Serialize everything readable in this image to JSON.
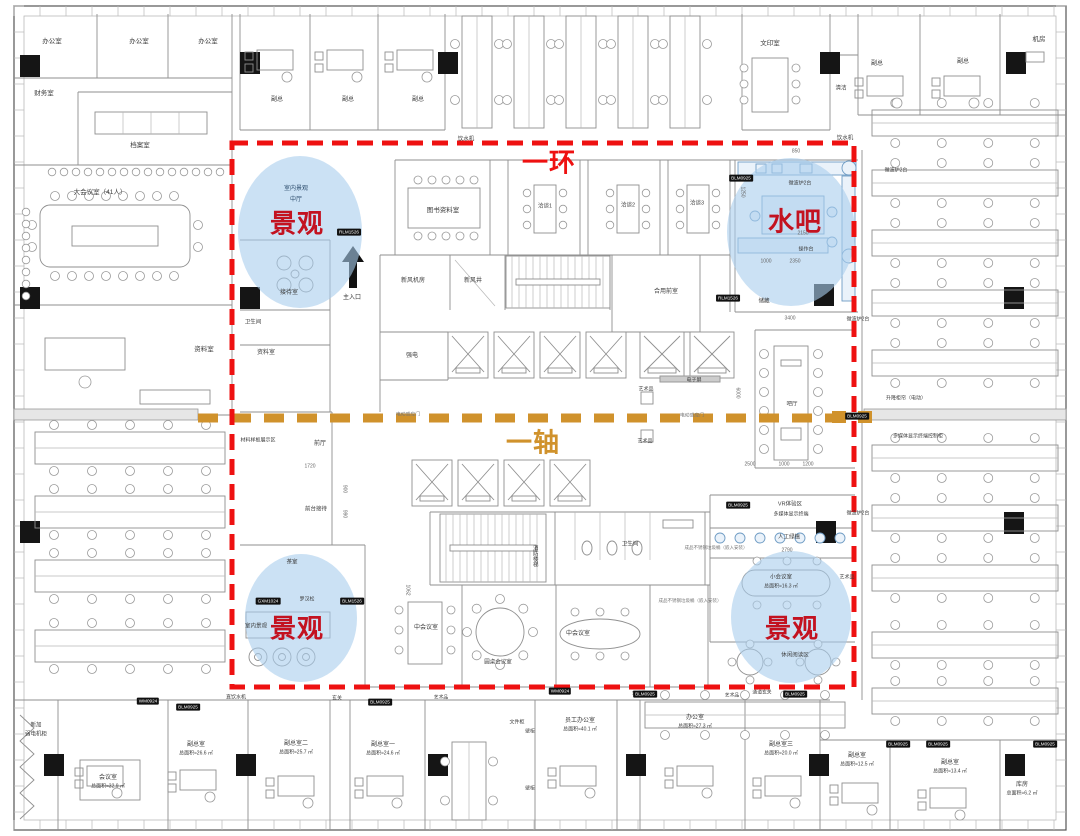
{
  "overlays": {
    "ring": {
      "label": "一环",
      "color": "#ee1111"
    },
    "axis": {
      "label": "一轴",
      "color": "#d0922c"
    },
    "zones": [
      {
        "id": "landscape-top-left",
        "label": "景观"
      },
      {
        "id": "water-bar-top-right",
        "label": "水吧"
      },
      {
        "id": "landscape-bottom-left",
        "label": "景观"
      },
      {
        "id": "landscape-bottom-right",
        "label": "景观"
      }
    ],
    "zone_fill": "#a9cdec",
    "zone_label_color": "#c31220"
  },
  "plan_labels": [
    {
      "t": "办公室",
      "x": 52,
      "y": 42
    },
    {
      "t": "办公室",
      "x": 139,
      "y": 42
    },
    {
      "t": "办公室",
      "x": 208,
      "y": 42
    },
    {
      "t": "财务室",
      "x": 44,
      "y": 94
    },
    {
      "t": "档案室",
      "x": 140,
      "y": 146
    },
    {
      "t": "大会议室（41人）",
      "x": 100,
      "y": 193
    },
    {
      "t": "资料室",
      "x": 204,
      "y": 350
    },
    {
      "t": "副总",
      "x": 277,
      "y": 100,
      "s": 6
    },
    {
      "t": "副总",
      "x": 348,
      "y": 100,
      "s": 6
    },
    {
      "t": "副总",
      "x": 418,
      "y": 100,
      "s": 6
    },
    {
      "t": "饮水机",
      "x": 466,
      "y": 140,
      "s": 5.5
    },
    {
      "t": "文印室",
      "x": 770,
      "y": 44
    },
    {
      "t": "清洁",
      "x": 841,
      "y": 89,
      "s": 5.5
    },
    {
      "t": "副总",
      "x": 877,
      "y": 64,
      "s": 6
    },
    {
      "t": "副总",
      "x": 963,
      "y": 62,
      "s": 6
    },
    {
      "t": "机房",
      "x": 1039,
      "y": 40
    },
    {
      "t": "饮水机",
      "x": 845,
      "y": 139,
      "s": 5.5
    },
    {
      "t": "室内景观",
      "x": 296,
      "y": 189,
      "s": 6,
      "c": "#2f4f6f"
    },
    {
      "t": "中厅",
      "x": 296,
      "y": 200,
      "s": 6,
      "c": "#2f4f6f"
    },
    {
      "t": "接待室",
      "x": 289,
      "y": 293,
      "s": 6
    },
    {
      "t": "主入口",
      "x": 352,
      "y": 298,
      "s": 6
    },
    {
      "t": "卫生间",
      "x": 253,
      "y": 323,
      "s": 5.5
    },
    {
      "t": "资料室",
      "x": 266,
      "y": 353,
      "s": 6
    },
    {
      "t": "图书资料室",
      "x": 443,
      "y": 211
    },
    {
      "t": "洽谈1",
      "x": 545,
      "y": 207,
      "s": 5.5
    },
    {
      "t": "洽谈2",
      "x": 628,
      "y": 206,
      "s": 5.5
    },
    {
      "t": "洽谈3",
      "x": 697,
      "y": 204,
      "s": 5.5
    },
    {
      "t": "新风机房",
      "x": 413,
      "y": 281,
      "s": 6
    },
    {
      "t": "新风井",
      "x": 473,
      "y": 281,
      "s": 6
    },
    {
      "t": "合用前室",
      "x": 666,
      "y": 292,
      "s": 6
    },
    {
      "t": "强电",
      "x": 412,
      "y": 356,
      "s": 6
    },
    {
      "t": "储藏",
      "x": 764,
      "y": 302,
      "s": 5.5
    },
    {
      "t": "微波炉2台",
      "x": 800,
      "y": 184,
      "s": 5
    },
    {
      "t": "操作台",
      "x": 806,
      "y": 250,
      "s": 5
    },
    {
      "t": "微波炉2台",
      "x": 896,
      "y": 171,
      "s": 5
    },
    {
      "t": "电子屏",
      "x": 694,
      "y": 381,
      "s": 5
    },
    {
      "t": "艺术品",
      "x": 646,
      "y": 390,
      "s": 5
    },
    {
      "t": "艺术品",
      "x": 645,
      "y": 442,
      "s": 5
    },
    {
      "t": "电动感应门",
      "x": 408,
      "y": 416,
      "s": 4.8,
      "c": "#777777"
    },
    {
      "t": "电动感应门",
      "x": 692,
      "y": 417,
      "s": 4.8,
      "c": "#777777"
    },
    {
      "t": "吧厅",
      "x": 792,
      "y": 405,
      "s": 5.5
    },
    {
      "t": "前厅",
      "x": 320,
      "y": 444,
      "s": 6
    },
    {
      "t": "材料样板展示区",
      "x": 258,
      "y": 441,
      "s": 5
    },
    {
      "t": "前台接待",
      "x": 316,
      "y": 510,
      "s": 5.5
    },
    {
      "t": "茶室",
      "x": 292,
      "y": 563,
      "s": 5.5
    },
    {
      "t": "罗汉松",
      "x": 307,
      "y": 600,
      "s": 5
    },
    {
      "t": "室内景观",
      "x": 256,
      "y": 627,
      "s": 5.5
    },
    {
      "t": "消防楼梯",
      "x": 534,
      "y": 556,
      "s": 5.5,
      "v": true
    },
    {
      "t": "卫生间",
      "x": 630,
      "y": 545,
      "s": 5.5
    },
    {
      "t": "中会议室",
      "x": 426,
      "y": 628,
      "s": 6
    },
    {
      "t": "圆桌会议室",
      "x": 498,
      "y": 663,
      "s": 5.5
    },
    {
      "t": "中会议室",
      "x": 578,
      "y": 634,
      "s": 6
    },
    {
      "t": "VR体验区",
      "x": 790,
      "y": 505,
      "s": 5.5
    },
    {
      "t": "多媒体显示终端",
      "x": 791,
      "y": 515,
      "s": 5
    },
    {
      "t": "人工绿植",
      "x": 789,
      "y": 538,
      "s": 5.5
    },
    {
      "t": "小会议室",
      "x": 781,
      "y": 578,
      "s": 5.5
    },
    {
      "t": "总面积≈16.3 ㎡",
      "x": 781,
      "y": 587,
      "s": 5
    },
    {
      "t": "艺术品",
      "x": 847,
      "y": 578,
      "s": 5
    },
    {
      "t": "休闲阅读区",
      "x": 795,
      "y": 656,
      "s": 5.5
    },
    {
      "t": "成品不锈钢垃圾桶（嵌入安装）",
      "x": 716,
      "y": 548,
      "s": 4.5,
      "c": "#777777"
    },
    {
      "t": "成品不锈钢垃圾桶（嵌入安装）",
      "x": 690,
      "y": 601,
      "s": 4.5,
      "c": "#777777"
    },
    {
      "t": "微波炉2台",
      "x": 858,
      "y": 320,
      "s": 5
    },
    {
      "t": "升降柜帘（电动）",
      "x": 906,
      "y": 399,
      "s": 5
    },
    {
      "t": "多媒体显示终端控制柜",
      "x": 918,
      "y": 437,
      "s": 5
    },
    {
      "t": "微波炉2台",
      "x": 858,
      "y": 514,
      "s": 5
    },
    {
      "t": "850",
      "x": 796,
      "y": 152,
      "s": 5,
      "c": "#666666"
    },
    {
      "t": "1250",
      "x": 742,
      "y": 192,
      "s": 5,
      "c": "#666666",
      "v": true
    },
    {
      "t": "2150",
      "x": 803,
      "y": 234,
      "s": 5,
      "c": "#666666"
    },
    {
      "t": "1000",
      "x": 766,
      "y": 262,
      "s": 5,
      "c": "#666666"
    },
    {
      "t": "2350",
      "x": 795,
      "y": 262,
      "s": 5,
      "c": "#666666"
    },
    {
      "t": "3400",
      "x": 790,
      "y": 319,
      "s": 5,
      "c": "#666666"
    },
    {
      "t": "6000",
      "x": 737,
      "y": 393,
      "s": 5,
      "c": "#666666",
      "v": true
    },
    {
      "t": "2500",
      "x": 750,
      "y": 465,
      "s": 5,
      "c": "#666666"
    },
    {
      "t": "1000",
      "x": 784,
      "y": 465,
      "s": 5,
      "c": "#666666"
    },
    {
      "t": "1200",
      "x": 808,
      "y": 465,
      "s": 5,
      "c": "#666666"
    },
    {
      "t": "1720",
      "x": 310,
      "y": 467,
      "s": 5,
      "c": "#666666"
    },
    {
      "t": "900",
      "x": 344,
      "y": 489,
      "s": 5,
      "c": "#666666",
      "v": true
    },
    {
      "t": "990",
      "x": 344,
      "y": 514,
      "s": 5,
      "c": "#666666",
      "v": true
    },
    {
      "t": "1062",
      "x": 407,
      "y": 590,
      "s": 5,
      "c": "#666666",
      "v": true
    },
    {
      "t": "2790",
      "x": 787,
      "y": 551,
      "s": 5,
      "c": "#666666"
    },
    {
      "t": "新加",
      "x": 36,
      "y": 726,
      "s": 5.5
    },
    {
      "t": "弱电机柜",
      "x": 36,
      "y": 735,
      "s": 5.5
    },
    {
      "t": "会议室",
      "x": 108,
      "y": 778,
      "s": 6
    },
    {
      "t": "总面积≈32.9 ㎡",
      "x": 108,
      "y": 787,
      "s": 5
    },
    {
      "t": "副总室",
      "x": 196,
      "y": 745,
      "s": 6
    },
    {
      "t": "总面积≈26.6 ㎡",
      "x": 196,
      "y": 754,
      "s": 5
    },
    {
      "t": "直饮水机",
      "x": 236,
      "y": 698,
      "s": 5
    },
    {
      "t": "玄关",
      "x": 337,
      "y": 699,
      "s": 5
    },
    {
      "t": "副总室二",
      "x": 296,
      "y": 744,
      "s": 6
    },
    {
      "t": "总面积≈25.7 ㎡",
      "x": 296,
      "y": 753,
      "s": 5
    },
    {
      "t": "副总室一",
      "x": 383,
      "y": 745,
      "s": 6
    },
    {
      "t": "总面积≈24.6 ㎡",
      "x": 383,
      "y": 754,
      "s": 5
    },
    {
      "t": "文件柜",
      "x": 517,
      "y": 723,
      "s": 5
    },
    {
      "t": "壁柜",
      "x": 530,
      "y": 733,
      "s": 4.8
    },
    {
      "t": "壁柜",
      "x": 530,
      "y": 790,
      "s": 4.8
    },
    {
      "t": "艺术品",
      "x": 441,
      "y": 699,
      "s": 4.8
    },
    {
      "t": "艺术品",
      "x": 639,
      "y": 695,
      "s": 4.8
    },
    {
      "t": "艺术品",
      "x": 732,
      "y": 697,
      "s": 4.8
    },
    {
      "t": "通道玄关",
      "x": 762,
      "y": 694,
      "s": 4.8
    },
    {
      "t": "员工办公室",
      "x": 580,
      "y": 721,
      "s": 6
    },
    {
      "t": "总面积≈40.1 ㎡",
      "x": 580,
      "y": 730,
      "s": 5
    },
    {
      "t": "办公室",
      "x": 695,
      "y": 718,
      "s": 6
    },
    {
      "t": "总面积≈27.3 ㎡",
      "x": 695,
      "y": 727,
      "s": 5
    },
    {
      "t": "副总室三",
      "x": 781,
      "y": 745,
      "s": 6
    },
    {
      "t": "总面积≈20.0 ㎡",
      "x": 781,
      "y": 754,
      "s": 5
    },
    {
      "t": "副总室",
      "x": 857,
      "y": 756,
      "s": 6
    },
    {
      "t": "总面积≈12.5 ㎡",
      "x": 857,
      "y": 765,
      "s": 5
    },
    {
      "t": "副总室",
      "x": 950,
      "y": 763,
      "s": 6
    },
    {
      "t": "总面积≈13.4 ㎡",
      "x": 950,
      "y": 772,
      "s": 5
    },
    {
      "t": "库房",
      "x": 1022,
      "y": 785,
      "s": 6
    },
    {
      "t": "总面积≈6.2 ㎡",
      "x": 1022,
      "y": 794,
      "s": 5
    }
  ],
  "tags": [
    {
      "t": "RLM1526",
      "x": 349,
      "y": 232
    },
    {
      "t": "BLM0925",
      "x": 741,
      "y": 178
    },
    {
      "t": "RLM1526",
      "x": 728,
      "y": 298
    },
    {
      "t": "BLM0925",
      "x": 857,
      "y": 416
    },
    {
      "t": "GXM1024",
      "x": 268,
      "y": 601
    },
    {
      "t": "BLM1526",
      "x": 352,
      "y": 601
    },
    {
      "t": "WM0924",
      "x": 148,
      "y": 701
    },
    {
      "t": "BLM0925",
      "x": 188,
      "y": 707
    },
    {
      "t": "BLM0925",
      "x": 380,
      "y": 702
    },
    {
      "t": "WM0924",
      "x": 560,
      "y": 691
    },
    {
      "t": "BLM0925",
      "x": 645,
      "y": 694
    },
    {
      "t": "BLM0925",
      "x": 795,
      "y": 694
    },
    {
      "t": "BLM0925",
      "x": 738,
      "y": 505
    },
    {
      "t": "BLM0925",
      "x": 898,
      "y": 744
    },
    {
      "t": "BLM0925",
      "x": 938,
      "y": 744
    },
    {
      "t": "BLM0925",
      "x": 1045,
      "y": 744
    }
  ]
}
